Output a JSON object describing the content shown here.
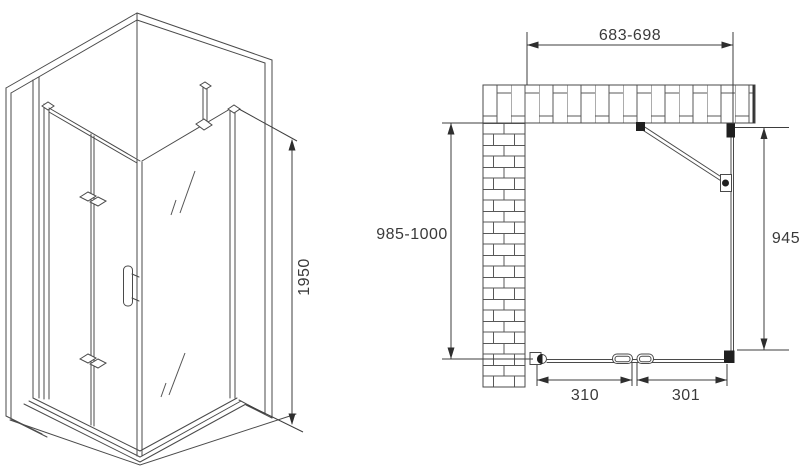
{
  "drawing": {
    "isometric_view": {
      "height_dim": "1950"
    },
    "plan_view": {
      "top_width_dim": "683-698",
      "left_depth_dim": "985-1000",
      "right_panel_dim": "945",
      "bottom_left_door_dim": "310",
      "bottom_right_door_dim": "301"
    },
    "colors": {
      "background": "#ffffff",
      "line": "#4a4a4a",
      "dimension_text": "#3a3a3a",
      "solid_profile": "#1f1f1f"
    }
  }
}
